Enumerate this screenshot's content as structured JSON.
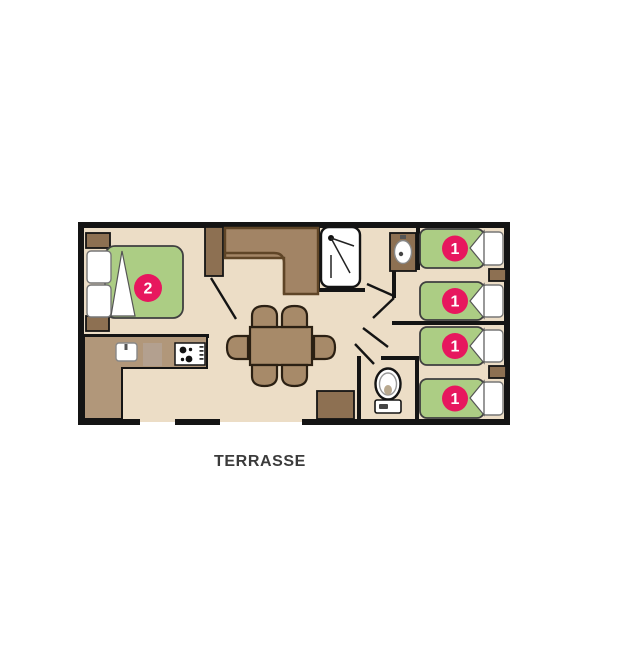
{
  "labels": {
    "terrace": "TERRASSE"
  },
  "beds": {
    "double": {
      "capacity": "2"
    },
    "singles": [
      {
        "capacity": "1"
      },
      {
        "capacity": "1"
      },
      {
        "capacity": "1"
      },
      {
        "capacity": "1"
      }
    ]
  },
  "icons": [
    "shower-icon",
    "washbasin-icon",
    "toilet-icon",
    "sink-icon",
    "stove-icon"
  ],
  "colors": {
    "floor": "#ecddc6",
    "wall": "#141414",
    "furniture-brown": "#8d7052",
    "counter-brown": "#b1977a",
    "sofa-brown": "#a28465",
    "sofa-edge": "#5f4527",
    "table-brown": "#a78a69",
    "mattress-green": "#accd84",
    "badge-pink": "#e7175e",
    "prep-beige": "#b3a08f",
    "text": "#3b3b3b"
  }
}
